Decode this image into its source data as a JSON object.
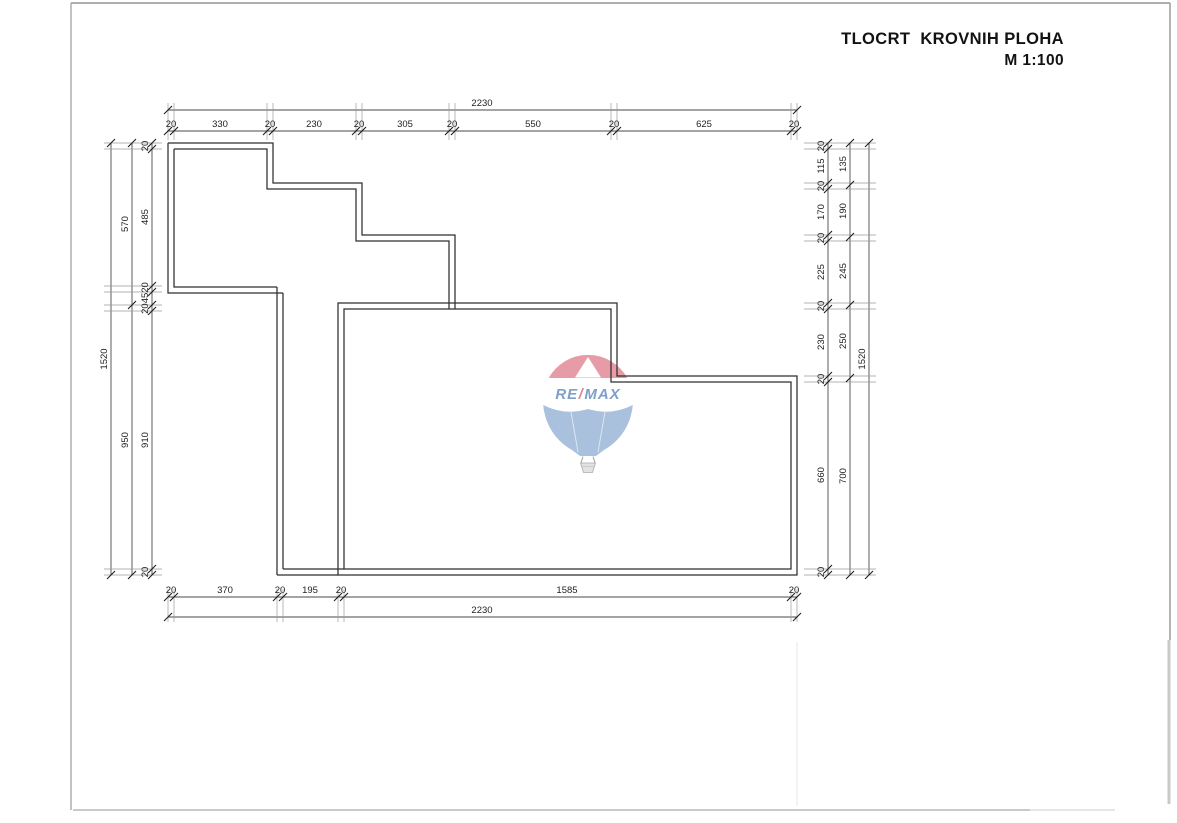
{
  "page": {
    "title_line1": "TLOCRT  KROVNIH PLOHA",
    "title_line2": "M 1:100"
  },
  "dimensions": {
    "top_overall": "2230",
    "top_chain": [
      "20",
      "330",
      "20",
      "230",
      "20",
      "305",
      "20",
      "550",
      "20",
      "625",
      "20"
    ],
    "bottom_chain": [
      "20",
      "370",
      "20",
      "195",
      "20",
      "1585",
      "20"
    ],
    "bottom_overall": "2230",
    "left_outer": "1520",
    "left_middle": [
      "570",
      "950"
    ],
    "left_inner": [
      "20",
      "485",
      "20",
      "45",
      "20",
      "910",
      "20"
    ],
    "left_inner_display": [
      "20",
      "485",
      "204520",
      "910",
      "20"
    ],
    "right_inner": [
      "20",
      "115",
      "20",
      "170",
      "20",
      "225",
      "20",
      "230",
      "20",
      "660",
      "20"
    ],
    "right_middle": [
      "135",
      "190",
      "245",
      "250",
      "700"
    ],
    "right_outer": "1520"
  },
  "watermark": {
    "brand_re": "RE",
    "brand_slash": "/",
    "brand_max": "MAX",
    "red": "#e79ba6",
    "blue": "#a9c1dd",
    "text_blue": "#7f9fcb",
    "slash_red": "#d88893"
  },
  "colors": {
    "wall": "#2f2f2f",
    "dim_line": "#4a4a4a",
    "dim_text": "#1f1f1f",
    "page_edge": "#a8a8a8"
  }
}
